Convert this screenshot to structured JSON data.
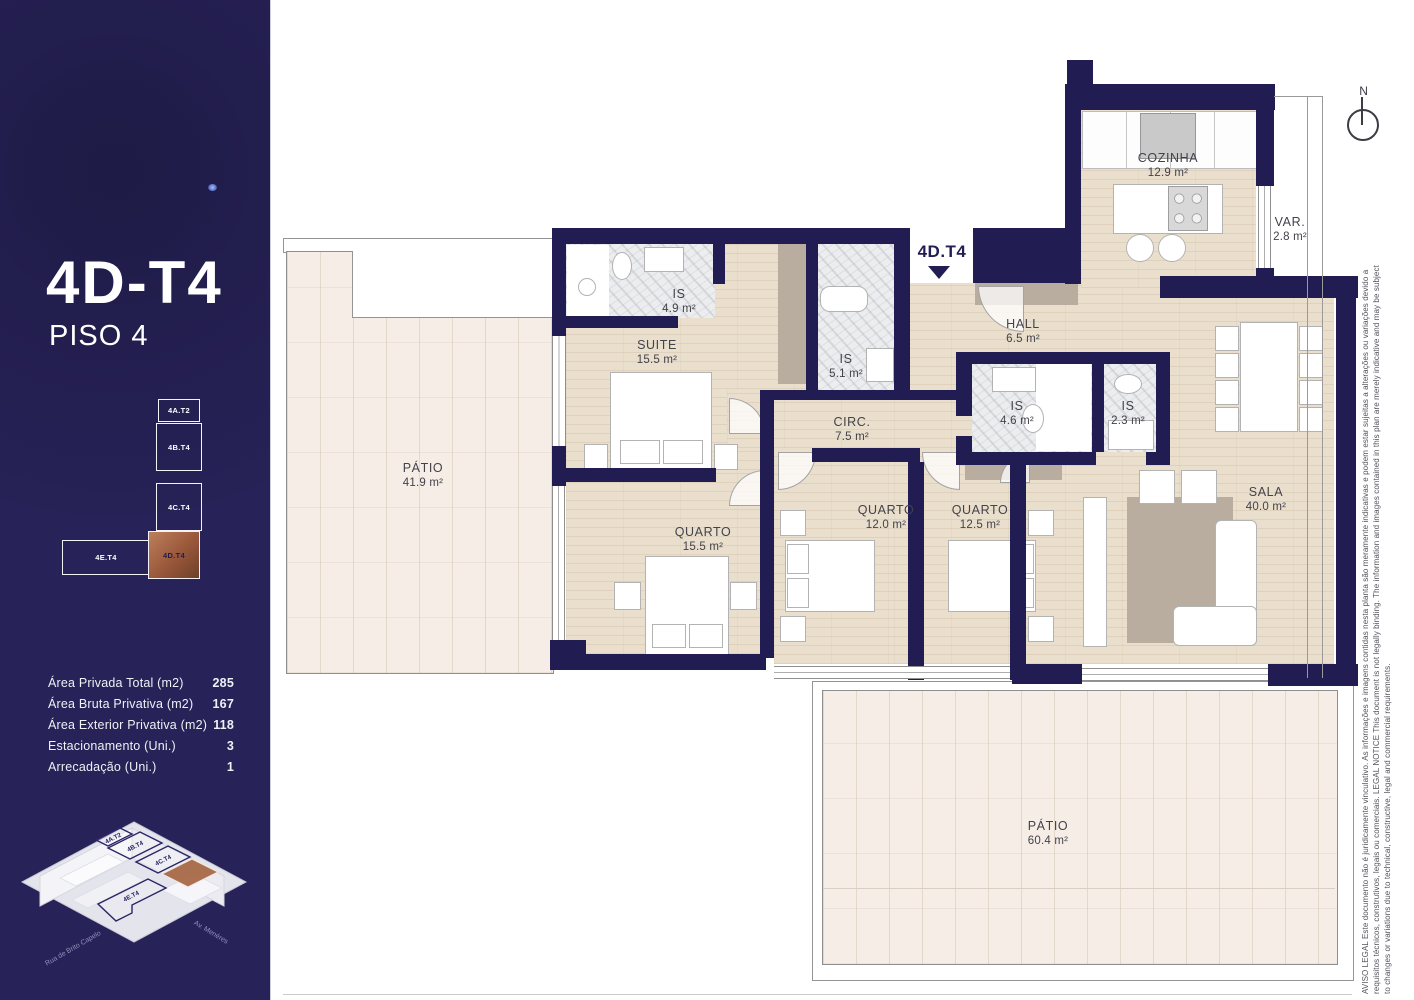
{
  "sidebar": {
    "title": "4D-T4",
    "subtitle": "PISO 4",
    "stack_units": [
      {
        "label": "4A.T2"
      },
      {
        "label": "4B.T4"
      },
      {
        "label": "4C.T4"
      },
      {
        "label": "4E.T4"
      },
      {
        "label": "4D.T4"
      }
    ],
    "areas": [
      {
        "label": "Área Privada Total (m2)",
        "value": "285"
      },
      {
        "label": "Área Bruta Privativa (m2)",
        "value": "167"
      },
      {
        "label": "Área Exterior Privativa (m2)",
        "value": "118"
      },
      {
        "label": "Estacionamento (Uni.)",
        "value": "3"
      },
      {
        "label": "Arrecadação (Uni.)",
        "value": "1"
      }
    ],
    "building_units": [
      "4A.T2",
      "4B.T4",
      "4C.T4",
      "4E.T4"
    ],
    "streets": {
      "left": "Rua de Brito Capelo",
      "right": "Av. Menéres"
    }
  },
  "plan": {
    "entrance_label": "4D.T4",
    "compass_n": "N",
    "rooms": [
      {
        "name": "COZINHA",
        "area": "12.9 m²"
      },
      {
        "name": "VAR.",
        "area": "2.8 m²"
      },
      {
        "name": "HALL",
        "area": "6.5 m²"
      },
      {
        "name": "IS",
        "area": "4.9 m²"
      },
      {
        "name": "SUITE",
        "area": "15.5 m²"
      },
      {
        "name": "IS",
        "area": "5.1 m²"
      },
      {
        "name": "CIRC.",
        "area": "7.5 m²"
      },
      {
        "name": "IS",
        "area": "4.6 m²"
      },
      {
        "name": "IS",
        "area": "2.3 m²"
      },
      {
        "name": "SALA",
        "area": "40.0 m²"
      },
      {
        "name": "PÁTIO",
        "area": "41.9 m²"
      },
      {
        "name": "QUARTO",
        "area": "15.5 m²"
      },
      {
        "name": "QUARTO",
        "area": "12.0 m²"
      },
      {
        "name": "QUARTO",
        "area": "12.5 m²"
      },
      {
        "name": "PÁTIO",
        "area": "60.4 m²"
      }
    ]
  },
  "legal": {
    "line1": "AVISO LEGAL Este documento não é juridicamente vinculativo. As informações e imagens contidas nesta planta são meramente indicativas e podem estar sujeitas a alterações ou variações devido a",
    "line2": "requisitos técnicos, construtivos, legais ou comerciais. LEGAL NOTICE This document is not legally binding. The information and images contained in this plan are merely indicative and may be subject",
    "line3": "to changes or variations due to technical, constructive, legal and commercial requirements."
  },
  "colors": {
    "navy": "#211c51",
    "copper": "#9a5c3a",
    "wood": "#eadfcd",
    "tile": "#f6eee6"
  }
}
